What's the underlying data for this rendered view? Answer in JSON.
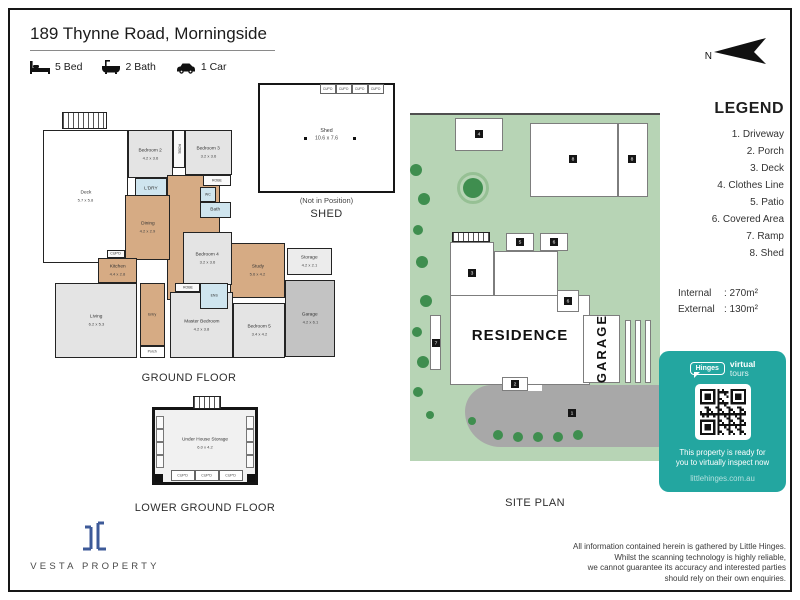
{
  "header": {
    "title": "189 Thynne Road, Morningside",
    "features": [
      {
        "icon": "bed-icon",
        "label": "5 Bed"
      },
      {
        "icon": "bath-icon",
        "label": "2 Bath"
      },
      {
        "icon": "car-icon",
        "label": "1 Car"
      }
    ]
  },
  "north": {
    "label": "N"
  },
  "captions": {
    "ground_floor": "GROUND FLOOR",
    "shed": "SHED",
    "site_plan": "SITE PLAN",
    "lower_ground_floor": "LOWER GROUND FLOOR"
  },
  "ground_floor": {
    "rooms": [
      {
        "type": "stairs",
        "x": 19,
        "y": 2,
        "w": 45,
        "h": 17
      },
      {
        "name": "Deck",
        "dims": "5.7 x 5.8",
        "type": "deck",
        "x": 0,
        "y": 20,
        "w": 85,
        "h": 133
      },
      {
        "name": "Bedroom 2",
        "dims": "4.2 x 3.6",
        "type": "room",
        "x": 85,
        "y": 20,
        "w": 45,
        "h": 48
      },
      {
        "name": "ROBE",
        "type": "util",
        "vert": true,
        "x": 130,
        "y": 20,
        "w": 12,
        "h": 38
      },
      {
        "name": "Bedroom 3",
        "dims": "3.2 x 3.6",
        "type": "room",
        "x": 142,
        "y": 20,
        "w": 47,
        "h": 45
      },
      {
        "name": "",
        "type": "wood",
        "x": 124,
        "y": 65,
        "w": 53,
        "h": 125
      },
      {
        "name": "ROBE",
        "type": "util",
        "x": 160,
        "y": 65,
        "w": 28,
        "h": 11
      },
      {
        "name": "L'DRY",
        "type": "wet",
        "x": 92,
        "y": 68,
        "w": 32,
        "h": 21
      },
      {
        "name": "Dining",
        "dims": "4.2 x 2.9",
        "type": "wood",
        "x": 82,
        "y": 85,
        "w": 45,
        "h": 65
      },
      {
        "name": "WC",
        "type": "wet",
        "x": 157,
        "y": 77,
        "w": 16,
        "h": 15
      },
      {
        "name": "Bath",
        "type": "wet",
        "x": 157,
        "y": 92,
        "w": 31,
        "h": 16
      },
      {
        "name": "Study",
        "dims": "5.6 x 4.2",
        "type": "wood",
        "x": 187,
        "y": 133,
        "w": 55,
        "h": 55
      },
      {
        "name": "Bedroom 4",
        "dims": "3.2 x 3.6",
        "type": "room",
        "x": 140,
        "y": 122,
        "w": 49,
        "h": 53
      },
      {
        "name": "Storage",
        "dims": "4.2 x 2.1",
        "type": "storage",
        "x": 244,
        "y": 138,
        "w": 45,
        "h": 27
      },
      {
        "name": "Garage",
        "dims": "4.2 x 6.1",
        "type": "garage",
        "x": 242,
        "y": 170,
        "w": 50,
        "h": 77
      },
      {
        "name": "Living",
        "dims": "6.2 x 5.3",
        "type": "room",
        "x": 12,
        "y": 173,
        "w": 82,
        "h": 75
      },
      {
        "name": "Kitchen",
        "dims": "4.4 x 2.8",
        "type": "wood",
        "x": 55,
        "y": 148,
        "w": 39,
        "h": 25
      },
      {
        "name": "CUP'D",
        "type": "util",
        "x": 64,
        "y": 140,
        "w": 18,
        "h": 8
      },
      {
        "name": "Entry",
        "type": "wood",
        "x": 97,
        "y": 173,
        "w": 25,
        "h": 63
      },
      {
        "name": "Master Bedroom",
        "dims": "4.2 x 3.8",
        "type": "room",
        "x": 127,
        "y": 182,
        "w": 63,
        "h": 66
      },
      {
        "name": "Bedroom 5",
        "dims": "3.4 x 4.2",
        "type": "room",
        "x": 190,
        "y": 193,
        "w": 52,
        "h": 55
      },
      {
        "name": "ENS",
        "type": "wet",
        "x": 157,
        "y": 173,
        "w": 28,
        "h": 26
      },
      {
        "name": "ROBE",
        "type": "util",
        "x": 132,
        "y": 173,
        "w": 25,
        "h": 9
      },
      {
        "name": "Porch",
        "type": "plain",
        "x": 97,
        "y": 236,
        "w": 25,
        "h": 12
      }
    ]
  },
  "shed_plan": {
    "name": "Shed",
    "dims": "10.6 x 7.6",
    "note": "(Not in Position)",
    "cupboards": [
      "CUP'D",
      "CUP'D",
      "CUP'D",
      "CUP'D"
    ]
  },
  "lower_ground": {
    "name": "Under House Storage",
    "dims": "6.0 x 4.2",
    "cupboards": [
      "CUP'D",
      "CUP'D",
      "CUP'D"
    ]
  },
  "site_plan": {
    "residence": "RESIDENCE",
    "garage": "GARAGE",
    "shapes": [
      {
        "kind": "drive",
        "x": 55,
        "y": 270,
        "w": 195,
        "h": 62
      },
      {
        "kind": "path",
        "x": 96,
        "y": 268,
        "w": 36,
        "h": 8
      },
      {
        "kind": "rect",
        "x": 45,
        "y": 3,
        "w": 48,
        "h": 33
      },
      {
        "kind": "rect",
        "x": 120,
        "y": 8,
        "w": 88,
        "h": 74
      },
      {
        "kind": "rect",
        "x": 208,
        "y": 8,
        "w": 30,
        "h": 74
      },
      {
        "kind": "hatch",
        "x": 42,
        "y": 117,
        "w": 38,
        "h": 10
      },
      {
        "kind": "rect",
        "x": 40,
        "y": 127,
        "w": 44,
        "h": 62
      },
      {
        "kind": "rect",
        "x": 96,
        "y": 118,
        "w": 28,
        "h": 18
      },
      {
        "kind": "rect",
        "x": 130,
        "y": 118,
        "w": 28,
        "h": 18
      },
      {
        "kind": "rect",
        "x": 84,
        "y": 136,
        "w": 64,
        "h": 48
      },
      {
        "kind": "rect",
        "x": 40,
        "y": 180,
        "w": 140,
        "h": 90
      },
      {
        "kind": "rect",
        "x": 147,
        "y": 175,
        "w": 22,
        "h": 22
      },
      {
        "kind": "rect",
        "x": 173,
        "y": 200,
        "w": 37,
        "h": 68
      },
      {
        "kind": "rect",
        "x": 215,
        "y": 205,
        "w": 6,
        "h": 63
      },
      {
        "kind": "rect",
        "x": 225,
        "y": 205,
        "w": 6,
        "h": 63
      },
      {
        "kind": "rect",
        "x": 235,
        "y": 205,
        "w": 6,
        "h": 63
      },
      {
        "kind": "rect",
        "x": 20,
        "y": 200,
        "w": 11,
        "h": 55
      },
      {
        "kind": "rect",
        "x": 92,
        "y": 262,
        "w": 26,
        "h": 14
      }
    ],
    "markers": [
      {
        "n": "4",
        "x": 69,
        "y": 19
      },
      {
        "n": "8",
        "x": 163,
        "y": 44
      },
      {
        "n": "8",
        "x": 222,
        "y": 44
      },
      {
        "n": "3",
        "x": 62,
        "y": 158
      },
      {
        "n": "5",
        "x": 110,
        "y": 127
      },
      {
        "n": "6",
        "x": 144,
        "y": 127
      },
      {
        "n": "6",
        "x": 158,
        "y": 186
      },
      {
        "n": "7",
        "x": 26,
        "y": 228
      },
      {
        "n": "2",
        "x": 105,
        "y": 269
      },
      {
        "n": "1",
        "x": 162,
        "y": 298
      }
    ],
    "trees": [
      {
        "x": 6,
        "y": 55,
        "r": 6
      },
      {
        "x": 14,
        "y": 84,
        "r": 6
      },
      {
        "x": 8,
        "y": 115,
        "r": 5
      },
      {
        "x": 12,
        "y": 147,
        "r": 6
      },
      {
        "x": 16,
        "y": 186,
        "r": 6
      },
      {
        "x": 7,
        "y": 217,
        "r": 5
      },
      {
        "x": 13,
        "y": 247,
        "r": 6
      },
      {
        "x": 8,
        "y": 277,
        "r": 5
      },
      {
        "x": 20,
        "y": 300,
        "r": 4
      },
      {
        "x": 62,
        "y": 306,
        "r": 4
      },
      {
        "x": 88,
        "y": 320,
        "r": 5
      },
      {
        "x": 108,
        "y": 322,
        "r": 5
      },
      {
        "x": 128,
        "y": 322,
        "r": 5
      },
      {
        "x": 148,
        "y": 322,
        "r": 5
      },
      {
        "x": 168,
        "y": 320,
        "r": 5
      }
    ],
    "ringed_tree": {
      "x": 63,
      "y": 73,
      "r": 10,
      "ring_r": 16
    }
  },
  "legend": {
    "title": "LEGEND",
    "items": [
      "1. Driveway",
      "2. Porch",
      "3. Deck",
      "4. Clothes Line",
      "5. Patio",
      "6. Covered Area",
      "7. Ramp",
      "8. Shed"
    ],
    "areas": [
      {
        "label": "Internal",
        "value": "270m²"
      },
      {
        "label": "External",
        "value": "130m²"
      }
    ]
  },
  "badge": {
    "brand": "Hinges",
    "tagline": [
      "virtual",
      "tours"
    ],
    "message": [
      "This property is ready for",
      "you to virtually inspect now"
    ],
    "url": "littlehinges.com.au",
    "bg": "#23a6a0"
  },
  "branding": {
    "name": "VESTA PROPERTY"
  },
  "disclaimer": [
    "All information contained herein is gathered by Little Hinges.",
    "Whilst the scanning technology is highly reliable,",
    "we cannot guarantee its accuracy and interested parties",
    "should rely on their own enquiries."
  ],
  "colors": {
    "wood": "#d6ab84",
    "room_gray": "#e4e4e4",
    "wet_blue": "#cfe5ef",
    "garage_gray": "#c3c3c3",
    "site_green": "#b7d4b5",
    "tree_green": "#3f8e4f",
    "driveway_gray": "#a8a8a8",
    "accent_teal": "#23a6a0",
    "logo_navy": "#3d5a98"
  }
}
